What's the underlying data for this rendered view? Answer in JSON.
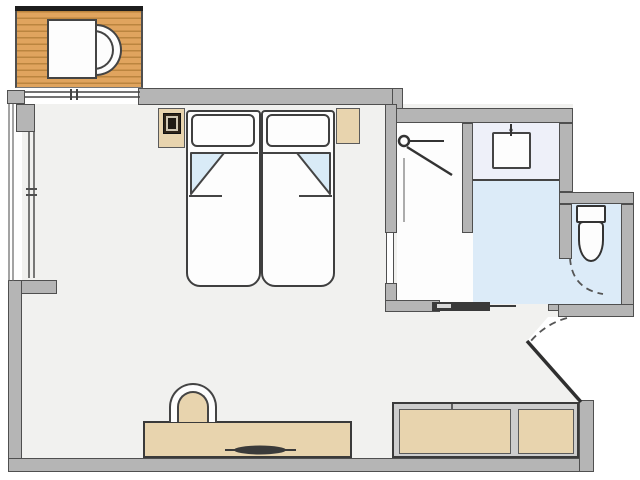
{
  "title": "Studio room floor plan",
  "palette": {
    "wall": "#b5b5b5",
    "wall_line": "#4f4f4f",
    "wood": "#e0a45e",
    "wood_line": "#bb853f",
    "tan": "#e8d4ae",
    "tan_line": "#5a5a5a",
    "floor": "#f1f1ef",
    "bath_blue": "#dcebf8",
    "counter": "#eef0f9",
    "sheet_blue": "#d9ebf7",
    "dark": "#333333",
    "white_f": "#fdfdfd",
    "outline_dark": "#3a3a3a"
  },
  "areas": [
    {
      "id": "balcony",
      "label": "balcony-deck"
    },
    {
      "id": "bedroom",
      "label": "main-bedroom"
    },
    {
      "id": "shower-room",
      "label": "shower-area"
    },
    {
      "id": "vanity",
      "label": "sink-counter"
    },
    {
      "id": "wc",
      "label": "toilet-niche"
    },
    {
      "id": "entry",
      "label": "angled-entry"
    }
  ],
  "furniture": [
    "balcony-table",
    "balcony-chair",
    "twin-bed-left",
    "twin-bed-right",
    "pillow-left",
    "pillow-right",
    "nightstand-left",
    "nightstand-right",
    "bedside-lamp",
    "desk",
    "desk-chair",
    "desk-accessory",
    "storage-bench-left",
    "storage-bench-right",
    "wash-basin",
    "toilet",
    "shower-head-symbol",
    "sliding-bathroom-door",
    "entry-door-swing",
    "wc-door-swing"
  ]
}
